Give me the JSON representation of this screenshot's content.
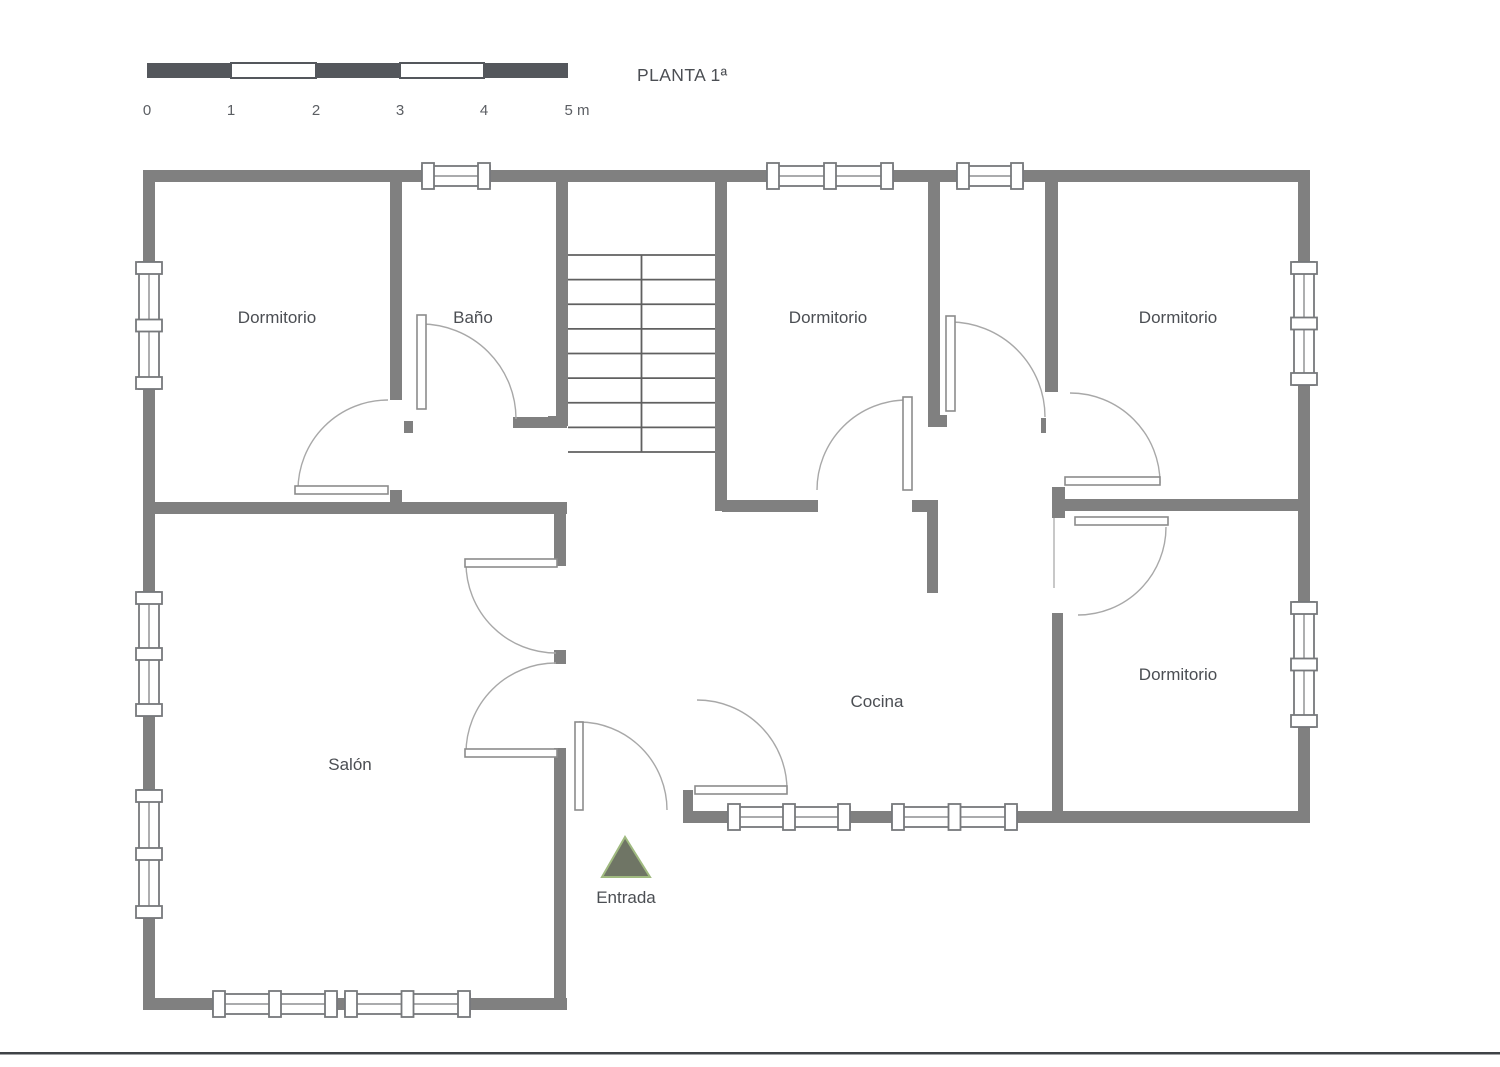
{
  "title": "PLANTA 1ª",
  "colors": {
    "wall": "#808080",
    "stair": "#606060",
    "win": "#77797c",
    "leaf": "#8c8c8c",
    "arc": "#a8a8a8",
    "label": "#4b4e53",
    "scaledark": "#54575c",
    "trifill": "#6f7565",
    "tristroke": "#a0ba80"
  },
  "scale_bar": {
    "boundaries": [
      147,
      231,
      316,
      400,
      484,
      568
    ],
    "y": 63,
    "h": 15,
    "label_y": 115,
    "tick_labels": [
      "0",
      "1",
      "2",
      "3",
      "4",
      "5 m"
    ],
    "tick_x": [
      147,
      231,
      316,
      400,
      484,
      577
    ]
  },
  "rooms": [
    {
      "id": "dormitorio-1",
      "label": "Dormitorio",
      "x": 277,
      "y": 323
    },
    {
      "id": "bano",
      "label": "Baño",
      "x": 473,
      "y": 323
    },
    {
      "id": "dormitorio-2",
      "label": "Dormitorio",
      "x": 828,
      "y": 323
    },
    {
      "id": "dormitorio-3",
      "label": "Dormitorio",
      "x": 1178,
      "y": 323
    },
    {
      "id": "dormitorio-4",
      "label": "Dormitorio",
      "x": 1178,
      "y": 680
    },
    {
      "id": "cocina",
      "label": "Cocina",
      "x": 877,
      "y": 707
    },
    {
      "id": "salon",
      "label": "Salón",
      "x": 350,
      "y": 770
    }
  ],
  "entrance": {
    "label": "Entrada",
    "label_x": 626,
    "label_y": 903,
    "triangle": [
      [
        625,
        837
      ],
      [
        602,
        877
      ],
      [
        650,
        877
      ]
    ]
  },
  "plan": {
    "walls": [
      [
        143,
        170,
        1167,
        12
      ],
      [
        143,
        170,
        12,
        840
      ],
      [
        143,
        998,
        424,
        12
      ],
      [
        1298,
        170,
        12,
        653
      ],
      [
        683,
        811,
        627,
        12
      ],
      [
        683,
        790,
        10,
        21
      ],
      [
        390,
        170,
        12,
        230
      ],
      [
        390,
        490,
        12,
        24
      ],
      [
        404,
        421,
        9,
        12
      ],
      [
        513,
        417,
        54,
        11
      ],
      [
        143,
        502,
        424,
        12
      ],
      [
        554,
        502,
        12,
        64
      ],
      [
        554,
        650,
        12,
        14
      ],
      [
        554,
        748,
        12,
        262
      ],
      [
        556,
        170,
        12,
        256
      ],
      [
        548,
        416,
        8,
        10
      ],
      [
        715,
        170,
        12,
        341
      ],
      [
        722,
        500,
        96,
        12
      ],
      [
        912,
        500,
        26,
        12
      ],
      [
        927,
        512,
        11,
        81
      ],
      [
        928,
        170,
        12,
        251
      ],
      [
        928,
        415,
        19,
        12
      ],
      [
        1041,
        418,
        5,
        15
      ],
      [
        1045,
        170,
        13,
        222
      ],
      [
        1052,
        487,
        13,
        31
      ],
      [
        1053,
        499,
        257,
        12
      ],
      [
        1052,
        613,
        11,
        198
      ]
    ],
    "stairs": {
      "x0": 568,
      "x1": 715,
      "y0": 255,
      "y1": 452,
      "rows": 8,
      "divider_x": 641.5
    },
    "windows": [
      {
        "o": "v",
        "c": 149,
        "a0": 262,
        "a1": 389,
        "caps": 3
      },
      {
        "o": "v",
        "c": 149,
        "a0": 592,
        "a1": 716,
        "caps": 3
      },
      {
        "o": "v",
        "c": 149,
        "a0": 790,
        "a1": 918,
        "caps": 3
      },
      {
        "o": "h",
        "c": 176,
        "a0": 422,
        "a1": 490,
        "caps": 2
      },
      {
        "o": "h",
        "c": 176,
        "a0": 767,
        "a1": 893,
        "caps": 3
      },
      {
        "o": "h",
        "c": 176,
        "a0": 957,
        "a1": 1023,
        "caps": 2
      },
      {
        "o": "v",
        "c": 1304,
        "a0": 262,
        "a1": 385,
        "caps": 3
      },
      {
        "o": "v",
        "c": 1304,
        "a0": 602,
        "a1": 727,
        "caps": 3
      },
      {
        "o": "h",
        "c": 817,
        "a0": 728,
        "a1": 850,
        "caps": 3
      },
      {
        "o": "h",
        "c": 817,
        "a0": 892,
        "a1": 1017,
        "caps": 3
      },
      {
        "o": "h",
        "c": 1004,
        "a0": 213,
        "a1": 337,
        "caps": 3
      },
      {
        "o": "h",
        "c": 1004,
        "a0": 345,
        "a1": 470,
        "caps": 3
      }
    ],
    "doors": [
      {
        "id": "door-dormitorio-1",
        "leaf": [
          295,
          486,
          93,
          8
        ],
        "arc": [
          90,
          298,
          490,
          388,
          400,
          1
        ]
      },
      {
        "id": "door-bano",
        "leaf": [
          417,
          315,
          9,
          94
        ],
        "arc": [
          95,
          421,
          324,
          516,
          419,
          1
        ]
      },
      {
        "id": "door-entrada",
        "leaf": [
          575,
          722,
          8,
          88
        ],
        "arc": [
          88,
          579,
          722,
          667,
          810,
          1
        ]
      },
      {
        "id": "door-salon-top",
        "leaf": [
          465,
          559,
          92,
          8
        ],
        "arc": [
          90,
          466,
          563,
          556,
          653,
          0
        ]
      },
      {
        "id": "door-salon-bottom",
        "leaf": [
          465,
          749,
          92,
          8
        ],
        "arc": [
          90,
          466,
          753,
          556,
          663,
          1
        ]
      },
      {
        "id": "door-cocina",
        "leaf": [
          695,
          786,
          92,
          8
        ],
        "arc": [
          90,
          697,
          700,
          787,
          790,
          1
        ]
      },
      {
        "id": "door-dormitorio-2",
        "leaf": [
          903,
          397,
          9,
          93
        ],
        "arc": [
          90,
          817,
          490,
          907,
          400,
          1
        ]
      },
      {
        "id": "door-aseo",
        "leaf": [
          946,
          316,
          9,
          95
        ],
        "arc": [
          95,
          950,
          322,
          1045,
          417,
          1
        ]
      },
      {
        "id": "door-dormitorio-3",
        "leaf": [
          1065,
          477,
          95,
          8
        ],
        "arc": [
          90,
          1070,
          393,
          1160,
          483,
          1
        ]
      },
      {
        "id": "door-dormitorio-4",
        "leaf": [
          1075,
          517,
          93,
          8
        ],
        "arc": [
          88,
          1166,
          527,
          1078,
          615,
          1
        ]
      }
    ],
    "thin_lines": [
      [
        1054,
        518,
        1054,
        588
      ]
    ]
  },
  "footer_rule": {
    "y": 1052,
    "h": 2.5
  }
}
